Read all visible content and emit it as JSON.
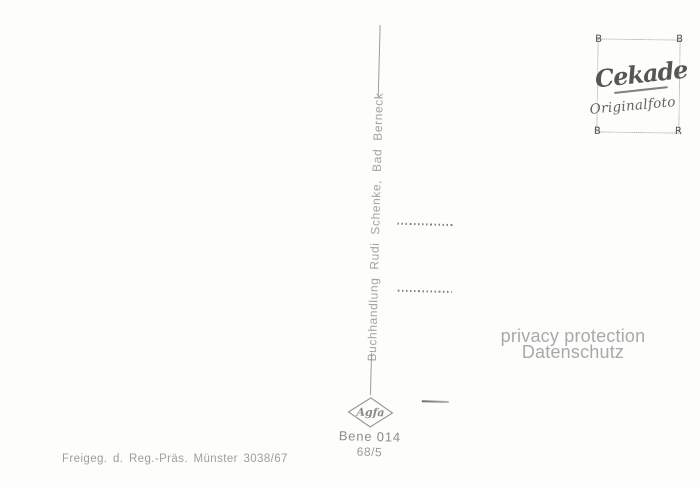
{
  "center": {
    "publisher_text": "Buchhandlung Rudi Schenke, Bad Berneck",
    "order_number": "Bene 014",
    "series_number": "68/5",
    "film_brand": "Agfa"
  },
  "stamp": {
    "brand": "Cekade",
    "subtitle": "Originalfoto",
    "corners": [
      "B",
      "B",
      "B",
      "R"
    ]
  },
  "watermark": {
    "line1": "privacy protection",
    "line2": "Datenschutz"
  },
  "footer": {
    "license_text": "Freigeg. d. Reg.-Präs. Münster 3038/67"
  },
  "colors": {
    "background": "#fdfdfc",
    "ink_gray": "#a4a49f",
    "stamp_gray": "#565654",
    "watermark_gray": "#a9a9a9"
  }
}
